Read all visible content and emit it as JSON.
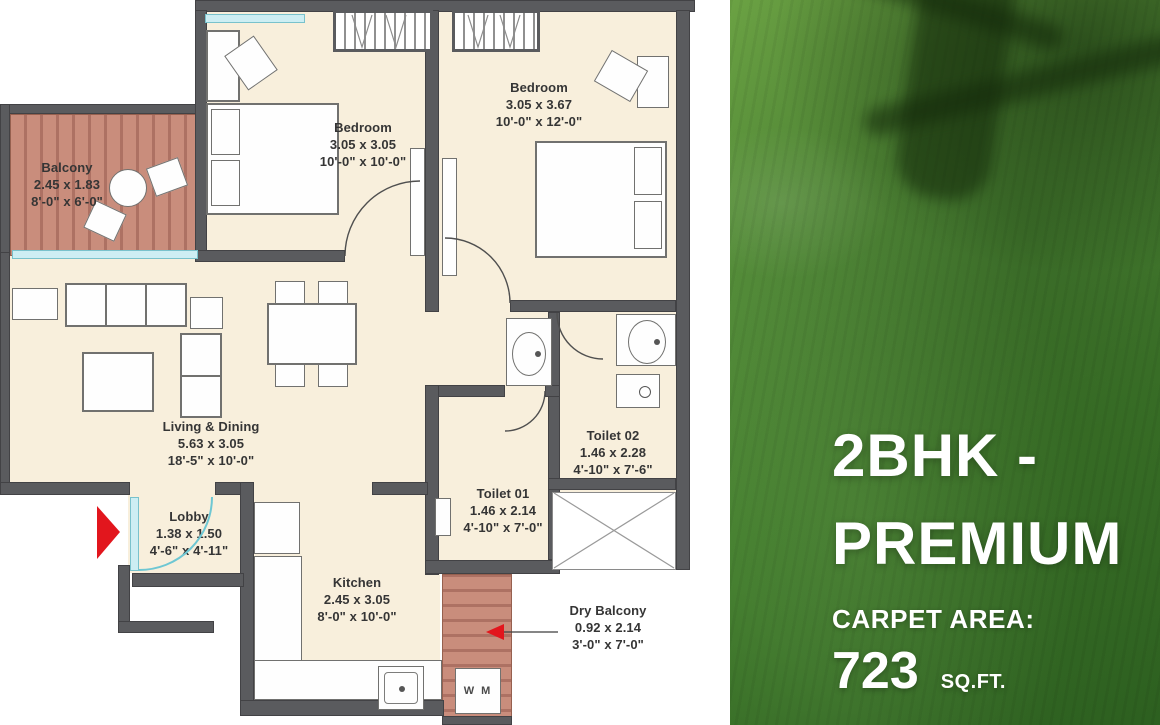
{
  "plan": {
    "rooms": {
      "balcony": {
        "name": "Balcony",
        "dim_m": "2.45 x 1.83",
        "dim_ft": "8'-0\" x 6'-0\""
      },
      "bedroom1": {
        "name": "Bedroom",
        "dim_m": "3.05 x 3.05",
        "dim_ft": "10'-0\" x 10'-0\""
      },
      "bedroom2": {
        "name": "Bedroom",
        "dim_m": "3.05 x 3.67",
        "dim_ft": "10'-0\" x 12'-0\""
      },
      "living": {
        "name": "Living & Dining",
        "dim_m": "5.63 x 3.05",
        "dim_ft": "18'-5\" x 10'-0\""
      },
      "lobby": {
        "name": "Lobby",
        "dim_m": "1.38 x 1.50",
        "dim_ft": "4'-6\" x 4'-11\""
      },
      "kitchen": {
        "name": "Kitchen",
        "dim_m": "2.45 x 3.05",
        "dim_ft": "8'-0\" x 10'-0\""
      },
      "toilet1": {
        "name": "Toilet 01",
        "dim_m": "1.46 x 2.14",
        "dim_ft": "4'-10\" x 7'-0\""
      },
      "toilet2": {
        "name": "Toilet 02",
        "dim_m": "1.46 x 2.28",
        "dim_ft": "4'-10\" x 7'-6\""
      },
      "dry_balcony": {
        "name": "Dry Balcony",
        "dim_m": "0.92 x 2.14",
        "dim_ft": "3'-0\" x 7'-0\""
      }
    },
    "washing_machine_label": "W M"
  },
  "panel": {
    "title_line1": "2BHK -",
    "title_line2": "PREMIUM",
    "carpet_area_label": "CARPET AREA:",
    "carpet_area_value": "723",
    "carpet_area_unit": "SQ.FT."
  },
  "colors": {
    "wall_gray": "#5a5b5e",
    "floor_cream": "#f8efdc",
    "balcony_terracotta": "#c98d7c",
    "panel_green": "#47812e",
    "entrance_arrow_red": "#e2161d",
    "door_swing_cyan": "#6ec7d3",
    "label_text": "#353535",
    "panel_text": "#ffffff"
  }
}
